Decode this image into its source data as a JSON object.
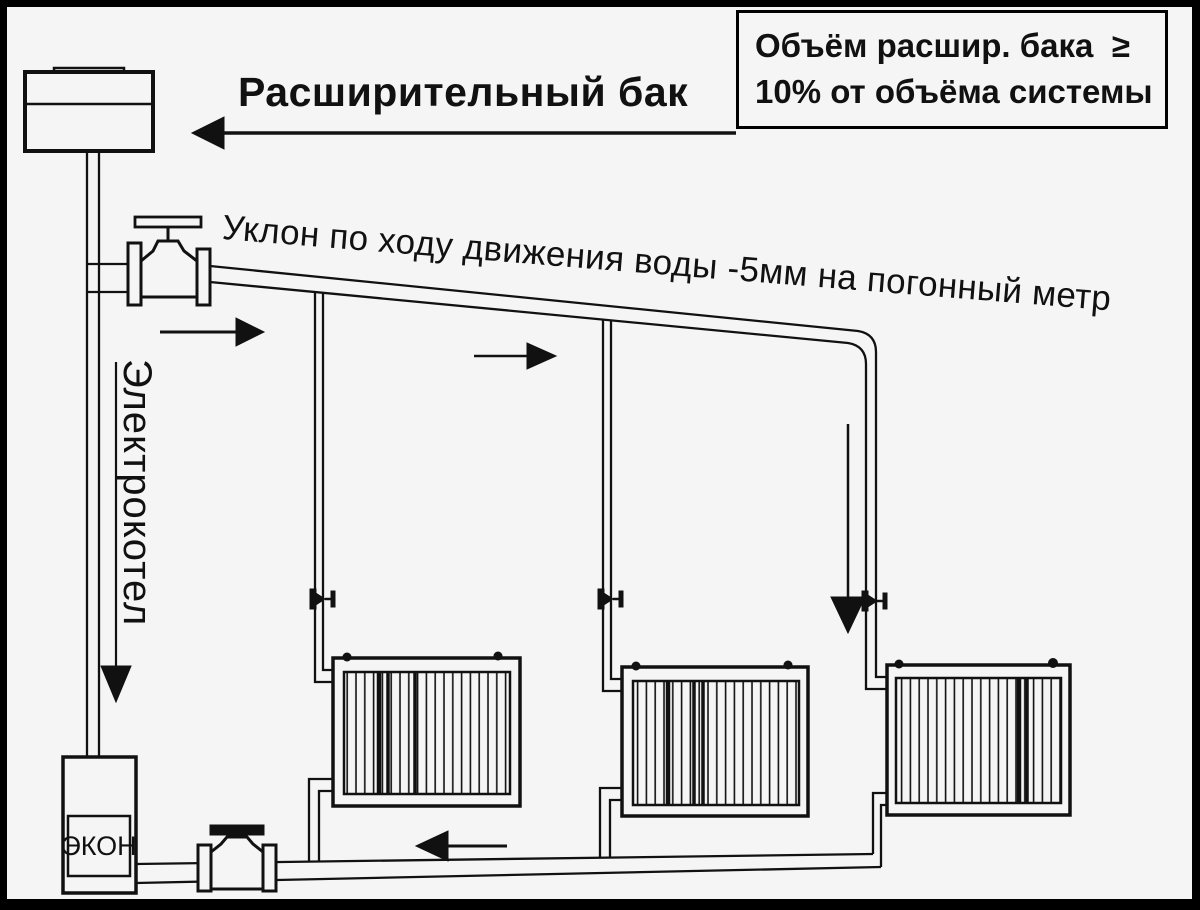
{
  "title": "Расширительный бак",
  "info_box": {
    "line1": "Объём расшир. бака  ≥",
    "line2": "10% от объёма системы"
  },
  "slope_note": "Уклон по ходу движения воды -5мм на погонный метр",
  "boiler_label_vertical": "Электрокотел",
  "boiler_unit_label": "ЭКОН",
  "colors": {
    "ink": "#111111",
    "paper": "#f5f5f5",
    "frame": "#000000"
  },
  "components": [
    "expansion-tank",
    "supply-shutoff-valve",
    "supply-main-pipe",
    "riser-valve-1",
    "riser-valve-2",
    "riser-valve-3",
    "radiator-1",
    "radiator-2",
    "radiator-3",
    "return-main-pipe",
    "return-shutoff-valve",
    "electric-boiler",
    "flow-direction-arrows"
  ]
}
